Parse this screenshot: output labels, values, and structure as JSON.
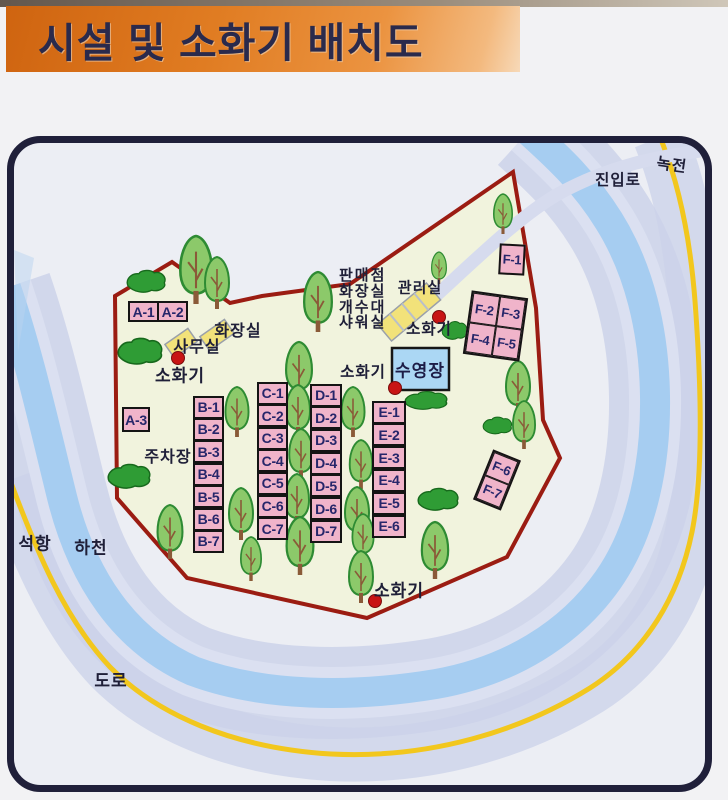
{
  "title": "시설 및 소화기 배치도",
  "colors": {
    "banner_orange": "#e8832c",
    "site_pink": "#f0b4ca",
    "pool_blue": "#abd7f4",
    "boundary_red": "#9b1c12",
    "camp_fill": "#f1f3dd",
    "river_blue": "#a6cdf1",
    "bank_lavender": "#cbd1e9",
    "road_yellow": "#f2c71d",
    "building_yellow": "#f2e27a",
    "tree_green": "#8cc96a",
    "marker_red": "#c81414"
  },
  "map": {
    "sites": {
      "a": [
        "A-1",
        "A-2",
        "A-3"
      ],
      "b": [
        "B-1",
        "B-2",
        "B-3",
        "B-4",
        "B-5",
        "B-6",
        "B-7"
      ],
      "c": [
        "C-1",
        "C-2",
        "C-3",
        "C-4",
        "C-5",
        "C-6",
        "C-7"
      ],
      "d": [
        "D-1",
        "D-2",
        "D-3",
        "D-4",
        "D-5",
        "D-6",
        "D-7"
      ],
      "e": [
        "E-1",
        "E-2",
        "E-3",
        "E-4",
        "E-5",
        "E-6"
      ],
      "f": [
        "F-1",
        "F-2",
        "F-3",
        "F-4",
        "F-5",
        "F-6",
        "F-7"
      ]
    },
    "facilities": {
      "toilet": "화장실",
      "office": "사무실",
      "service_building": [
        "판매점",
        "화장실",
        "개수대",
        "샤워실"
      ],
      "admin_office": "관리실",
      "pool": "수영장",
      "parking": "주차장"
    },
    "fire_extinguisher": "소화기",
    "surroundings": {
      "seokhang": "석항",
      "stream": "하천",
      "road": "도로",
      "entry_road": "진입로",
      "nokjeon": "녹전"
    }
  }
}
